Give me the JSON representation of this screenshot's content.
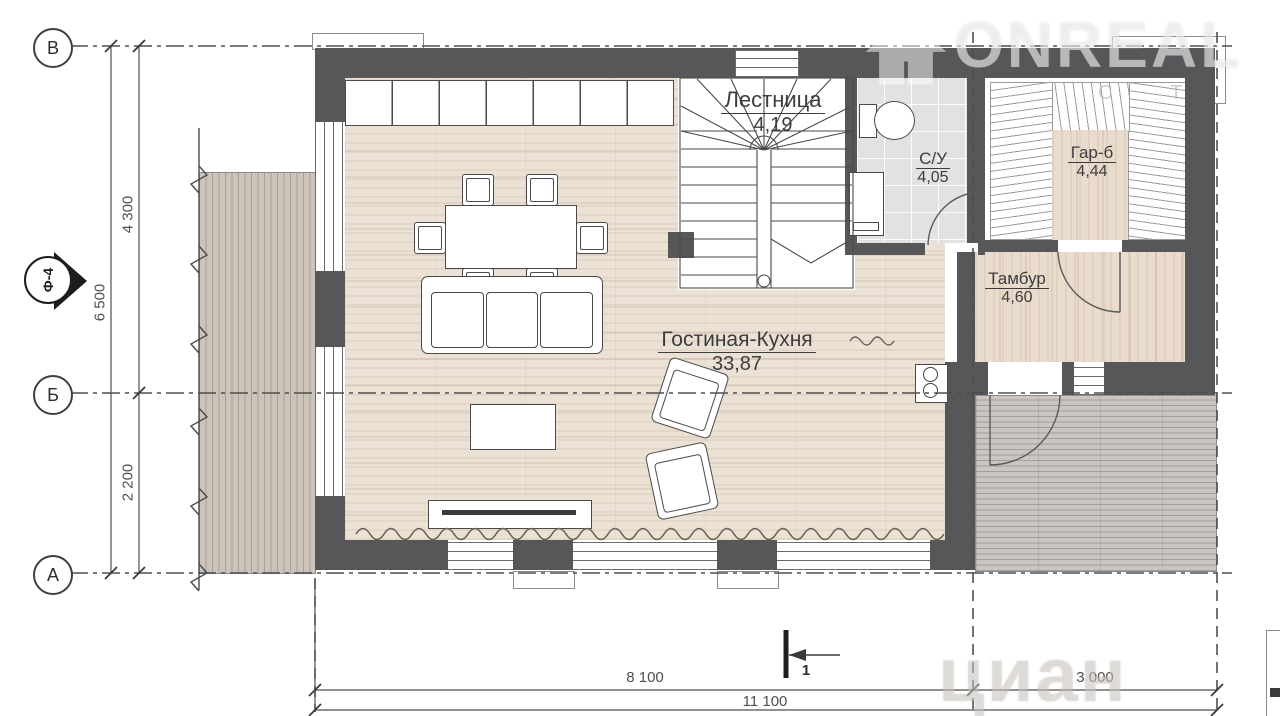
{
  "watermark": {
    "brand": "ONREAL",
    "brand_sub": "С Т",
    "corner_brand": "циан",
    "logo": "house-icon"
  },
  "axes": {
    "row_top": "В",
    "row_mid": "Б",
    "row_bottom": "А",
    "view_marker": "Ф-4",
    "section_marker": "1"
  },
  "dimensions": {
    "left_total": "6 500",
    "left_upper": "4 300",
    "left_lower": "2 200",
    "bottom_left": "8 100",
    "bottom_right": "3 000",
    "bottom_total": "11 100"
  },
  "rooms": [
    {
      "name": "Лестница",
      "area": "4,19"
    },
    {
      "name": "С/У",
      "area": "4,05"
    },
    {
      "name": "Гар-б",
      "area": "4,44"
    },
    {
      "name": "Тамбур",
      "area": "4,60"
    },
    {
      "name": "Гостиная-Кухня",
      "area": "33,87"
    }
  ],
  "colors": {
    "wall": "#57575a",
    "wood_floor": "#ebe1d4",
    "tile_floor": "#e3e2e0",
    "deck": "#ccc4bb",
    "porch": "#cbc6c1",
    "line": "#4a4a4c"
  }
}
